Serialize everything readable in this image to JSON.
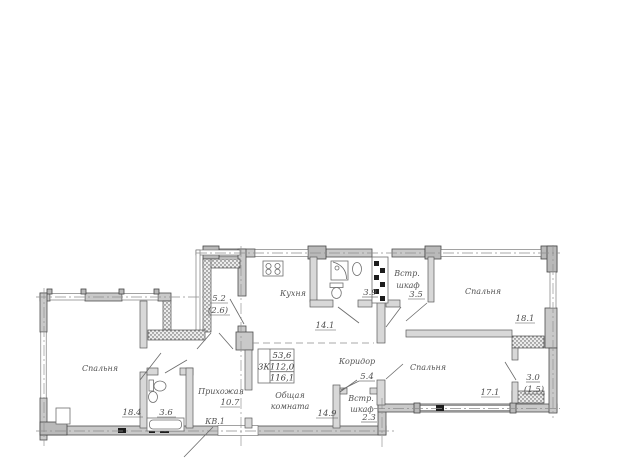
{
  "apartment": {
    "number_label": "КВ.1",
    "summary_table": {
      "rooms_count": "3К",
      "living_area": "53,6",
      "area": "112,0",
      "total_area": "116,1"
    },
    "rooms": {
      "bedroom_left": {
        "name": "Спальня",
        "area": "18.4"
      },
      "bathroom_small": {
        "area": "3.6"
      },
      "hallway": {
        "name": "Прихожая",
        "area": "10.7"
      },
      "balcony_left": {
        "area": "5.2",
        "area_reduced": "(2.6)"
      },
      "kitchen": {
        "name": "Кухня",
        "area": "14.1"
      },
      "bathroom_big": {
        "area": "3.9"
      },
      "closet_top": {
        "name_line1": "Встр.",
        "name_line2": "шкаф",
        "area": "3.5"
      },
      "bedroom_top_right": {
        "name": "Спальня",
        "area": "18.1"
      },
      "corridor": {
        "name": "Коридор",
        "area": "5.4"
      },
      "living_room": {
        "name_line1": "Общая",
        "name_line2": "комната",
        "area": "14.9"
      },
      "closet_bottom": {
        "name_line1": "Встр.",
        "name_line2": "шкаф",
        "area": "2.3"
      },
      "bedroom_bottom_right": {
        "name": "Спальня",
        "area": "17.1"
      },
      "balcony_right": {
        "area": "3.0",
        "area_reduced": "(1.5)"
      }
    }
  },
  "colors": {
    "background": "#ffffff",
    "exterior_wall": "#c9c9c9",
    "interior_wall": "#d8d8d8",
    "line": "#4d4d4d",
    "text": "#545454"
  }
}
